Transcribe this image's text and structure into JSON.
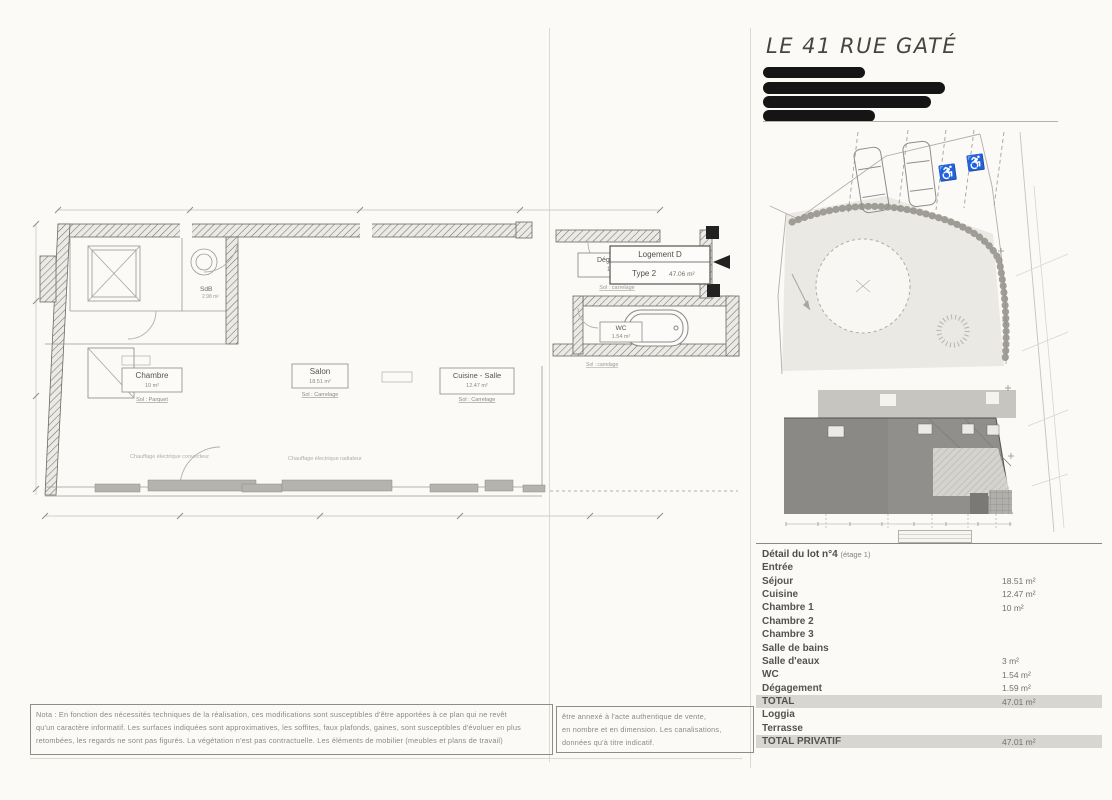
{
  "page": {
    "title": "LE 41 RUE GATÉ"
  },
  "colors": {
    "highlight_row": "#d8d6d0",
    "redaction": "#151515",
    "window_fill": "#b5b3ae"
  },
  "icons": {
    "handicap": "♿"
  },
  "floor_plan": {
    "logement_box": {
      "line1": "Logement D",
      "type": "Type 2",
      "area": "47.06 m²"
    },
    "rooms": {
      "chambre": {
        "label": "Chambre",
        "area": "10 m²",
        "floor": "Sol : Parquet"
      },
      "salon": {
        "label": "Salon",
        "area": "18.51 m²",
        "floor": "Sol : Carrelage"
      },
      "cuisine": {
        "label": "Cuisine - Salle",
        "area": "12.47 m²",
        "floor": "Sol : Carrelage"
      },
      "degagement": {
        "label": "Dégagement",
        "area": "1.59 m²",
        "floor": "Sol : carrelage"
      },
      "wc": {
        "label": "WC",
        "area": "1.54 m²",
        "floor": "Sol : carrelage"
      },
      "sdb": {
        "label": "SdB",
        "area": "2.98 m²"
      }
    },
    "annotations": {
      "heating1": "Chauffage électrique convecteur",
      "heating2": "Chauffage électrique radiateur"
    }
  },
  "detail_table": {
    "title": "Détail du lot n°4",
    "title_suffix": "(étage 1)",
    "rows": [
      {
        "label": "Entrée",
        "value": ""
      },
      {
        "label": "Séjour",
        "value": "18.51 m²"
      },
      {
        "label": "Cuisine",
        "value": "12.47 m²"
      },
      {
        "label": "Chambre 1",
        "value": "10 m²"
      },
      {
        "label": "Chambre 2",
        "value": ""
      },
      {
        "label": "Chambre 3",
        "value": ""
      },
      {
        "label": "Salle de bains",
        "value": ""
      },
      {
        "label": "Salle d'eaux",
        "value": "3 m²"
      },
      {
        "label": "WC",
        "value": "1.54 m²"
      },
      {
        "label": "Dégagement",
        "value": "1.59 m²"
      },
      {
        "label": "TOTAL",
        "value": "47.01 m²",
        "highlight": true
      },
      {
        "label": "Loggia",
        "value": ""
      },
      {
        "label": "Terrasse",
        "value": ""
      },
      {
        "label": "TOTAL PRIVATIF",
        "value": "47.01 m²",
        "highlight": true
      }
    ]
  },
  "notes": {
    "left_lines": [
      "Nota : En fonction des nécessités techniques de la réalisation, ces modifications sont susceptibles d'être apportées à ce plan qui ne revêt",
      "qu'un caractère informatif. Les surfaces indiquées sont approximatives, les soffites, faux plafonds, gaines, sont susceptibles d'évoluer en plus",
      "retombées, les regards ne sont pas figurés. La végétation n'est pas contractuelle. Les éléments de mobilier (meubles et plans de travail)"
    ],
    "right_lines": [
      "être annexé à l'acte authentique de vente,",
      "en nombre et en dimension. Les canalisations,",
      "données qu'à titre indicatif."
    ]
  }
}
